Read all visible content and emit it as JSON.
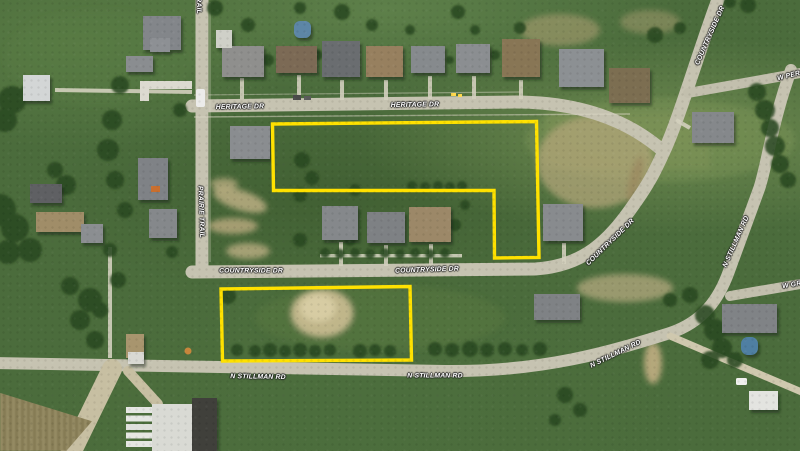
{
  "map": {
    "view_type": "satellite-aerial",
    "scene": "Residential subdivision aerial view with two vacant parcels outlined in yellow",
    "highlight_color": "#FFE100",
    "label_color": "#FFFFFF",
    "road_color": "#C6C3B1",
    "grass_color": "#4B6C3C"
  },
  "labels": [
    {
      "id": "heritage-dr-1",
      "text": "HERITAGE DR"
    },
    {
      "id": "heritage-dr-2",
      "text": "HERITAGE DR"
    },
    {
      "id": "countryside-dr-ne",
      "text": "COUNTRYSIDE DR"
    },
    {
      "id": "w-per-partial",
      "text": "W PER"
    },
    {
      "id": "prairie-trail-top-partial",
      "text": "PRAIRIE TRAIL"
    },
    {
      "id": "prairie-trail",
      "text": "PRAIRIE TRAIL"
    },
    {
      "id": "countryside-dr-1",
      "text": "COUNTRYSIDE DR"
    },
    {
      "id": "countryside-dr-2",
      "text": "COUNTRYSIDE DR"
    },
    {
      "id": "countryside-dr-diag",
      "text": "COUNTRYSIDE DR"
    },
    {
      "id": "n-stillman-rd-east",
      "text": "N STILLMAN RD"
    },
    {
      "id": "n-stillman-rd-1",
      "text": "N STILLMAN RD"
    },
    {
      "id": "n-stillman-rd-2",
      "text": "N STILLMAN RD"
    },
    {
      "id": "n-stillman-rd-diag",
      "text": "N STILLMAN RD"
    },
    {
      "id": "w-gr-partial",
      "text": "W GR"
    }
  ],
  "parcels": [
    {
      "name": "north-parcel",
      "shape": "L-shape",
      "outline": "#FFE100"
    },
    {
      "name": "south-parcel",
      "shape": "rectangle",
      "outline": "#FFE100"
    }
  ]
}
